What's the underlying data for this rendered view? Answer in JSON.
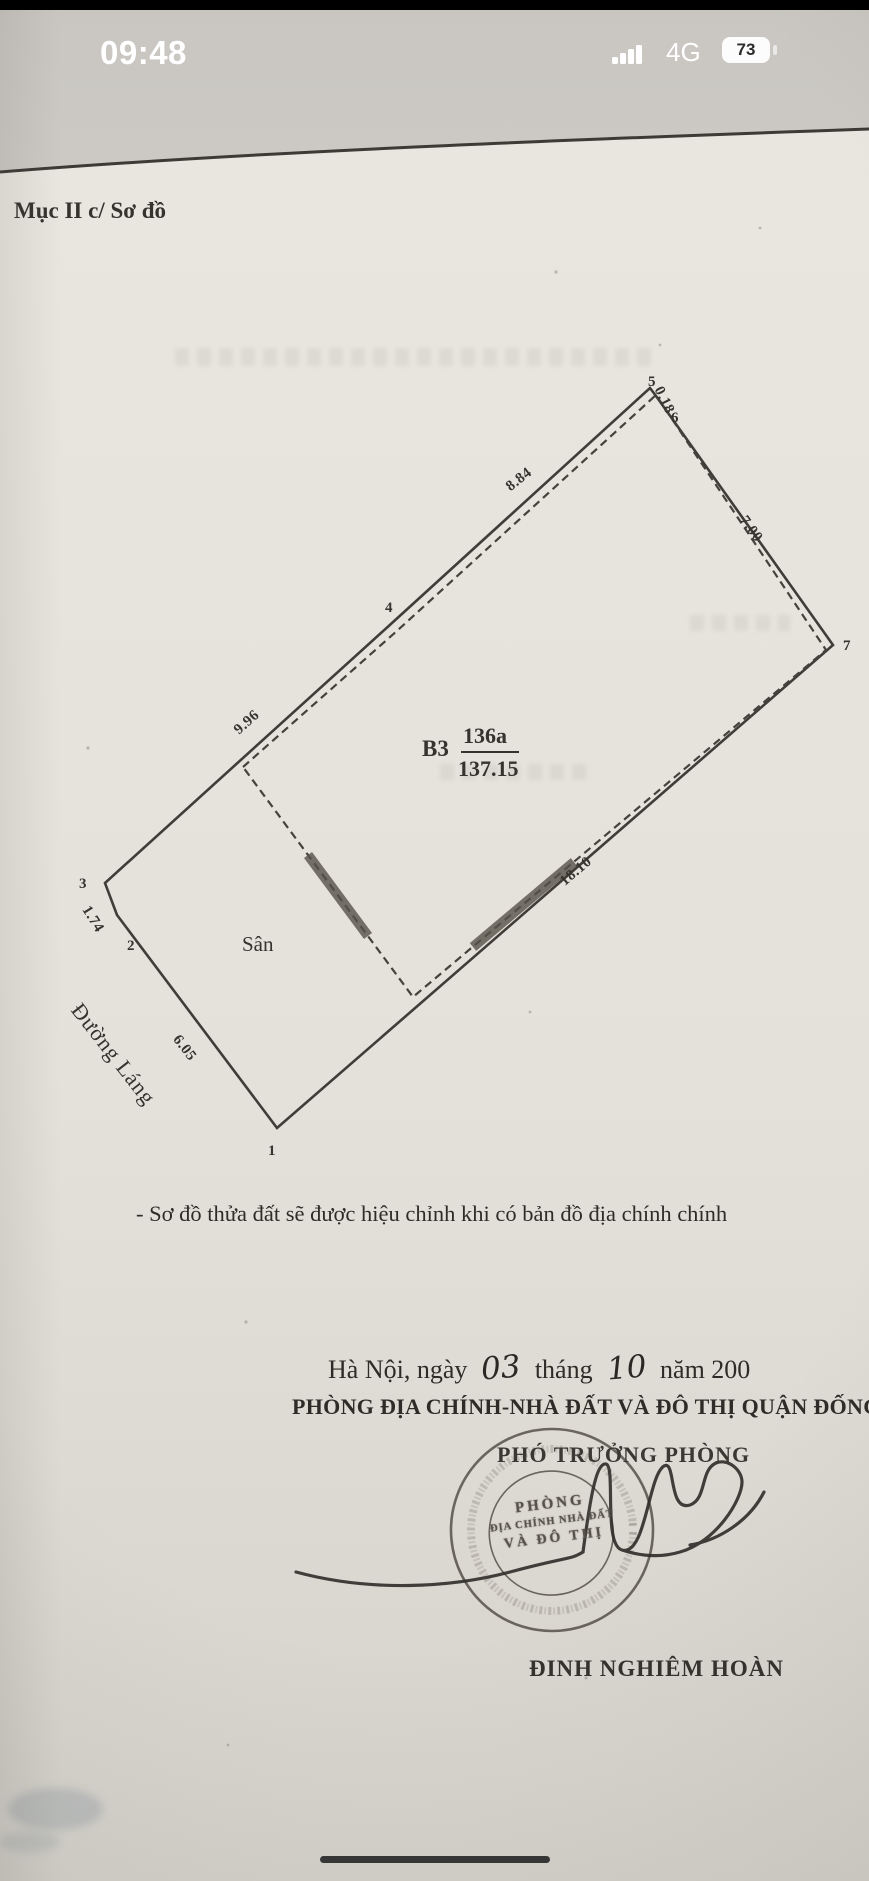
{
  "status_bar": {
    "time": "09:48",
    "network": "4G",
    "battery_percent": "73"
  },
  "doc": {
    "section_title": "Mục II c/ Sơ đồ",
    "note": "- Sơ đồ thửa đất sẽ được hiệu chỉnh khi có bản đồ địa chính chính",
    "date": {
      "prefix": "Hà Nội, ngày",
      "day": "03",
      "sep1": "tháng",
      "month": "10",
      "sep2": "năm 200"
    },
    "office_line": "PHÒNG ĐỊA CHÍNH-NHÀ ĐẤT VÀ ĐÔ THỊ QUẬN ĐỐNG",
    "signer_title": "PHÓ TRƯỞNG PHÒNG",
    "signer_name": "ĐINH NGHIÊM HOÀN",
    "stamp": {
      "line1": "PHÒNG",
      "line2": "ĐỊA CHÍNH NHÀ ĐẤT",
      "line3": "VÀ ĐÔ THỊ"
    }
  },
  "diagram": {
    "block_label": "B3",
    "parcel_number": "136a",
    "parcel_area": "137.15",
    "yard_label": "Sân",
    "street_label": "Đường Láng",
    "vertices": {
      "v1": "1",
      "v2": "2",
      "v3": "3",
      "v4": "4",
      "v5": "5",
      "v6": "6",
      "v7": "7"
    },
    "edges": {
      "e2_1": "6.05",
      "e3_2": "1.74",
      "e3_4": "9.96",
      "e4_5": "8.84",
      "e5_6": "0.18",
      "e6_7": "7.00",
      "e7_1": "18.10"
    }
  },
  "colors": {
    "ink": "#35332e",
    "paper": "#e8e5de",
    "photo_bg": "#c9c6c1",
    "stamp": "#4c4941"
  }
}
